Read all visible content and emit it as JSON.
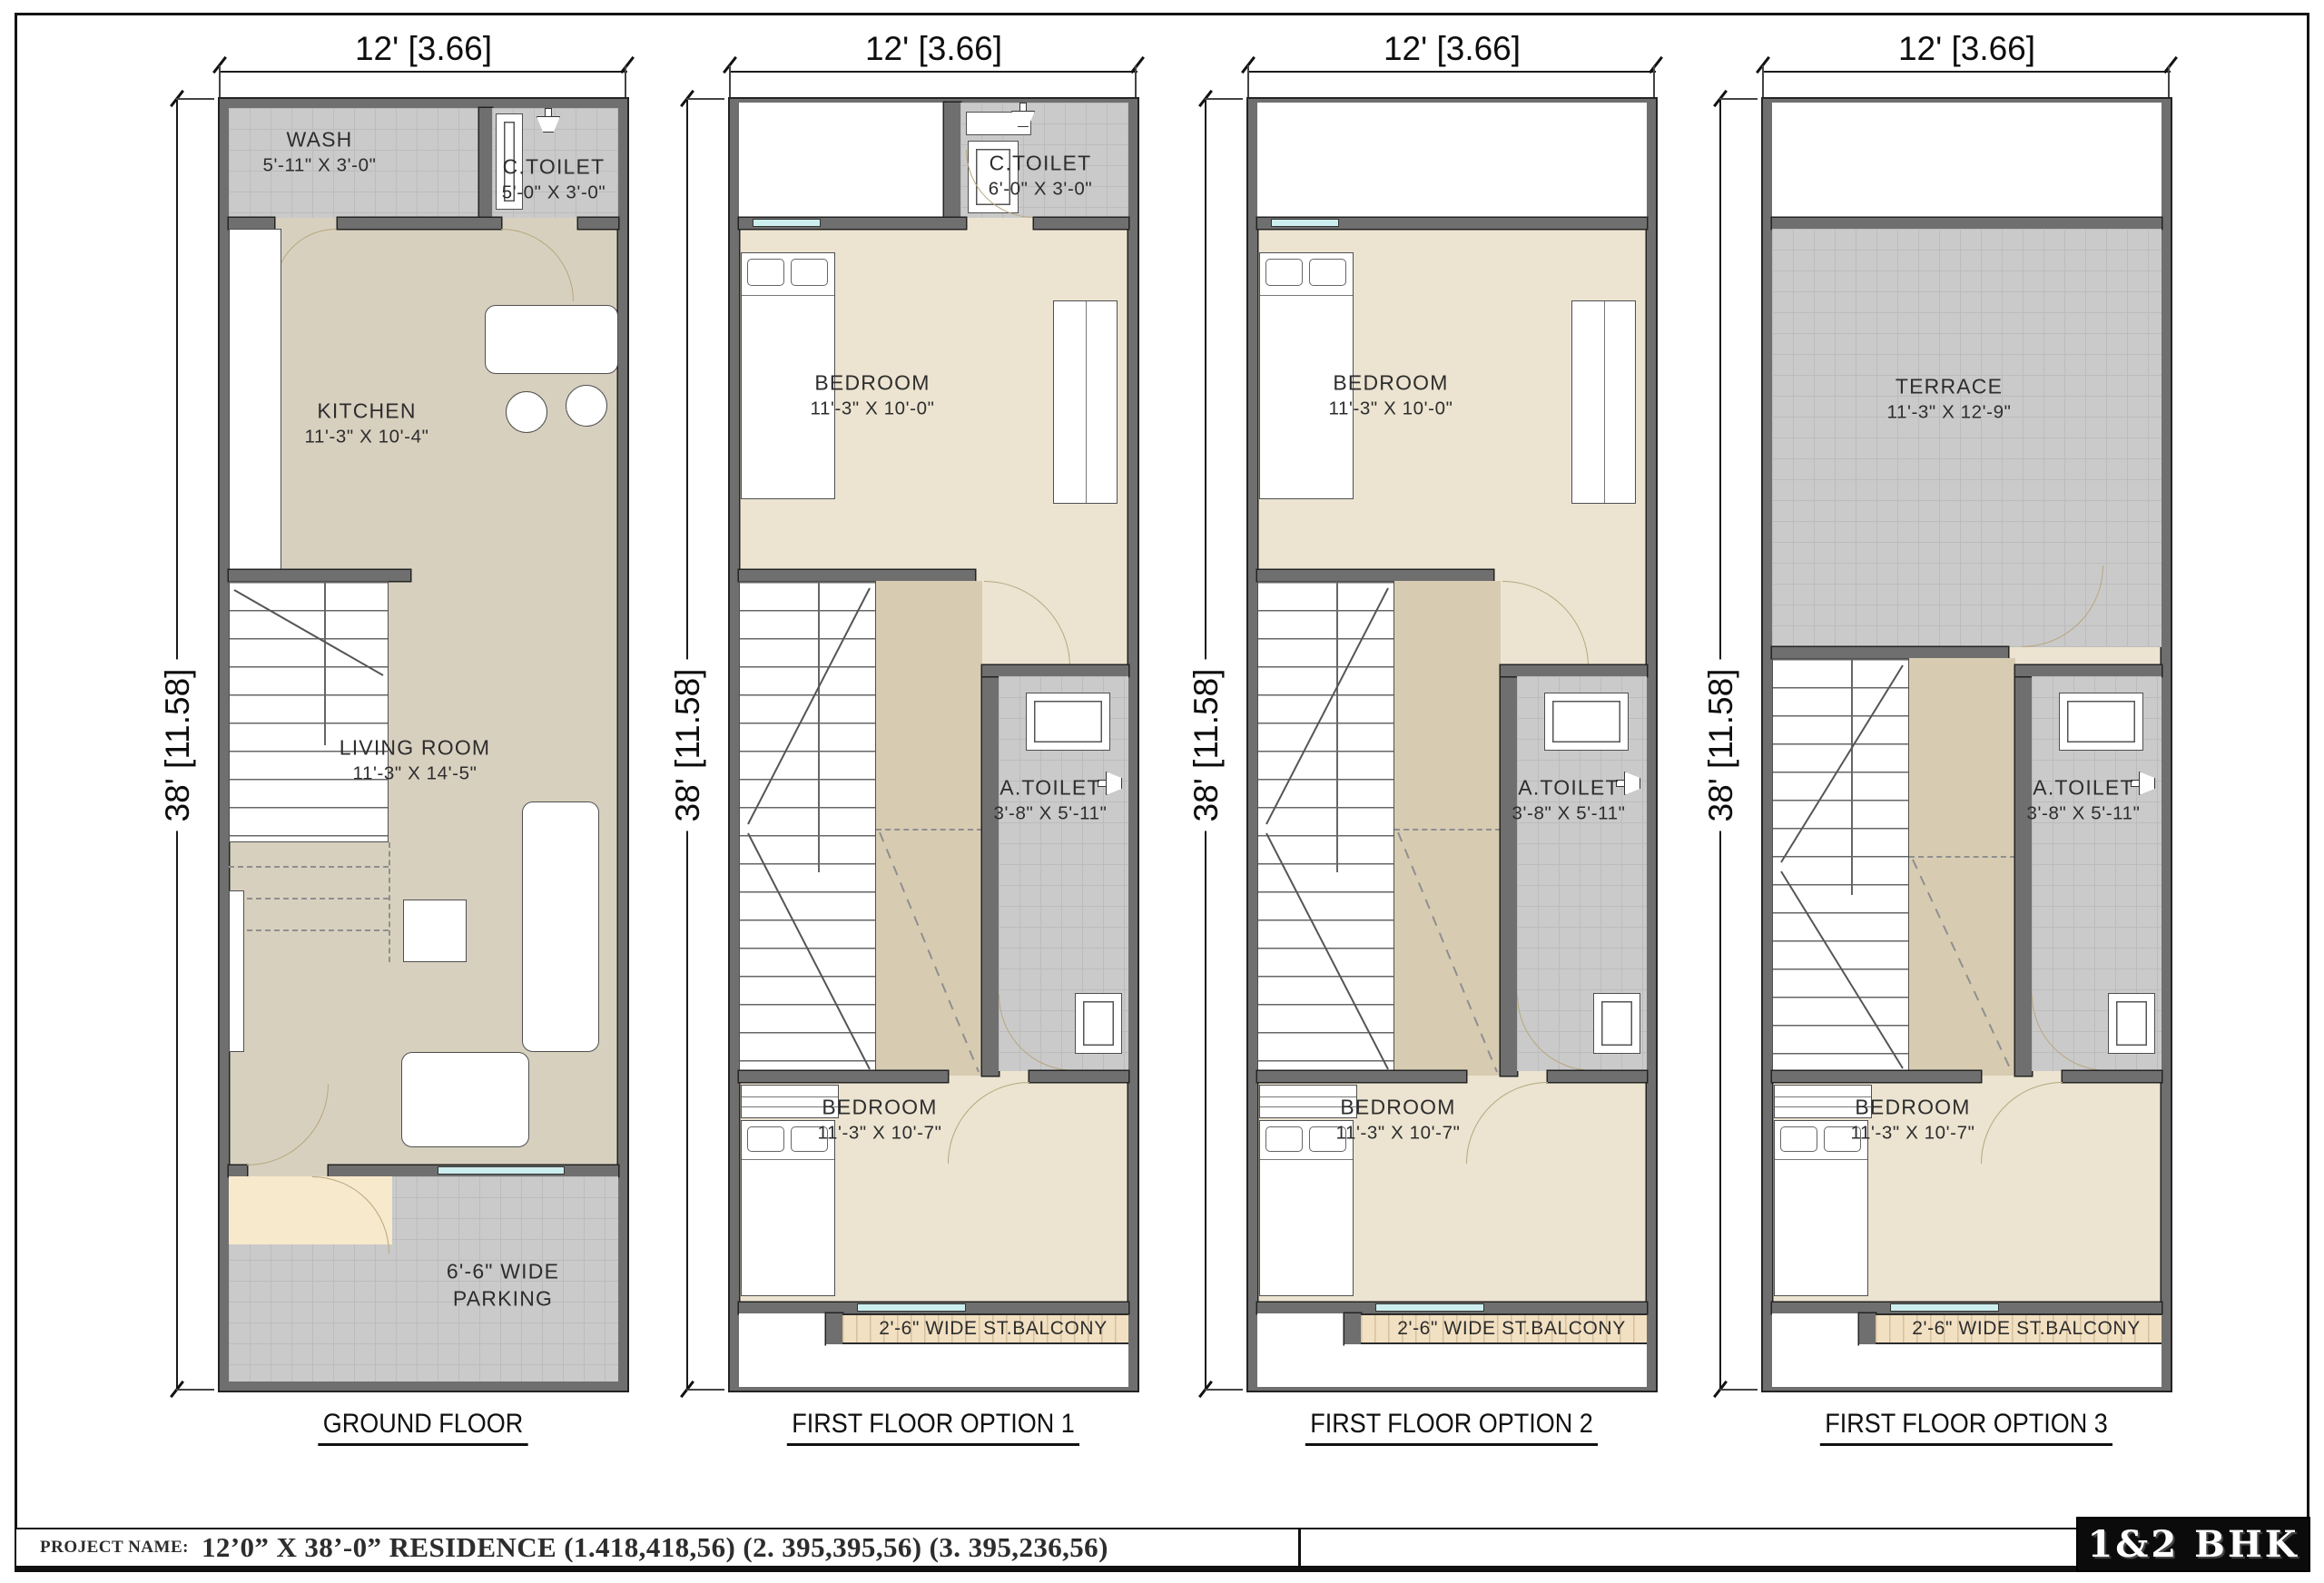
{
  "sheet": {
    "dim_width": "12' [3.66]",
    "dim_height": "38' [11.58]",
    "titlebar": {
      "prefix": "PROJECT NAME:",
      "title": "12’0” X 38’-0” RESIDENCE (1.418,418,56) (2. 395,395,56) (3. 395,236,56)",
      "badge": "1&2 BHK"
    }
  },
  "plans": [
    {
      "name": "GROUND FLOOR",
      "labels": {
        "wash": {
          "name": "WASH",
          "size": "5'-11\" X 3'-0\""
        },
        "ctoilet": {
          "name": "C.TOILET",
          "size": "5'-0\" X 3'-0\""
        },
        "kitchen": {
          "name": "KITCHEN",
          "size": "11'-3\" X 10'-4\""
        },
        "living": {
          "name": "LIVING ROOM",
          "size": "11'-3\" X 14'-5\""
        },
        "parking": {
          "name": "6'-6\" WIDE",
          "size": "PARKING"
        }
      }
    },
    {
      "name": "FIRST FLOOR OPTION 1",
      "labels": {
        "ctoilet": {
          "name": "C.TOILET",
          "size": "6'-0\" X 3'-0\""
        },
        "bedroom1": {
          "name": "BEDROOM",
          "size": "11'-3\" X 10'-0\""
        },
        "atoilet": {
          "name": "A.TOILET",
          "size": "3'-8\" X 5'-11\""
        },
        "bedroom2": {
          "name": "BEDROOM",
          "size": "11'-3\" X 10'-7\""
        },
        "balcony": "2'-6\" WIDE ST.BALCONY"
      }
    },
    {
      "name": "FIRST FLOOR OPTION 2",
      "labels": {
        "bedroom1": {
          "name": "BEDROOM",
          "size": "11'-3\" X 10'-0\""
        },
        "atoilet": {
          "name": "A.TOILET",
          "size": "3'-8\" X 5'-11\""
        },
        "bedroom2": {
          "name": "BEDROOM",
          "size": "11'-3\" X 10'-7\""
        },
        "balcony": "2'-6\" WIDE ST.BALCONY"
      }
    },
    {
      "name": "FIRST FLOOR OPTION 3",
      "labels": {
        "terrace": {
          "name": "TERRACE",
          "size": "11'-3\" X 12'-9\""
        },
        "atoilet": {
          "name": "A.TOILET",
          "size": "3'-8\" X 5'-11\""
        },
        "bedroom2": {
          "name": "BEDROOM",
          "size": "11'-3\" X 10'-7\""
        },
        "balcony": "2'-6\" WIDE ST.BALCONY"
      }
    }
  ]
}
